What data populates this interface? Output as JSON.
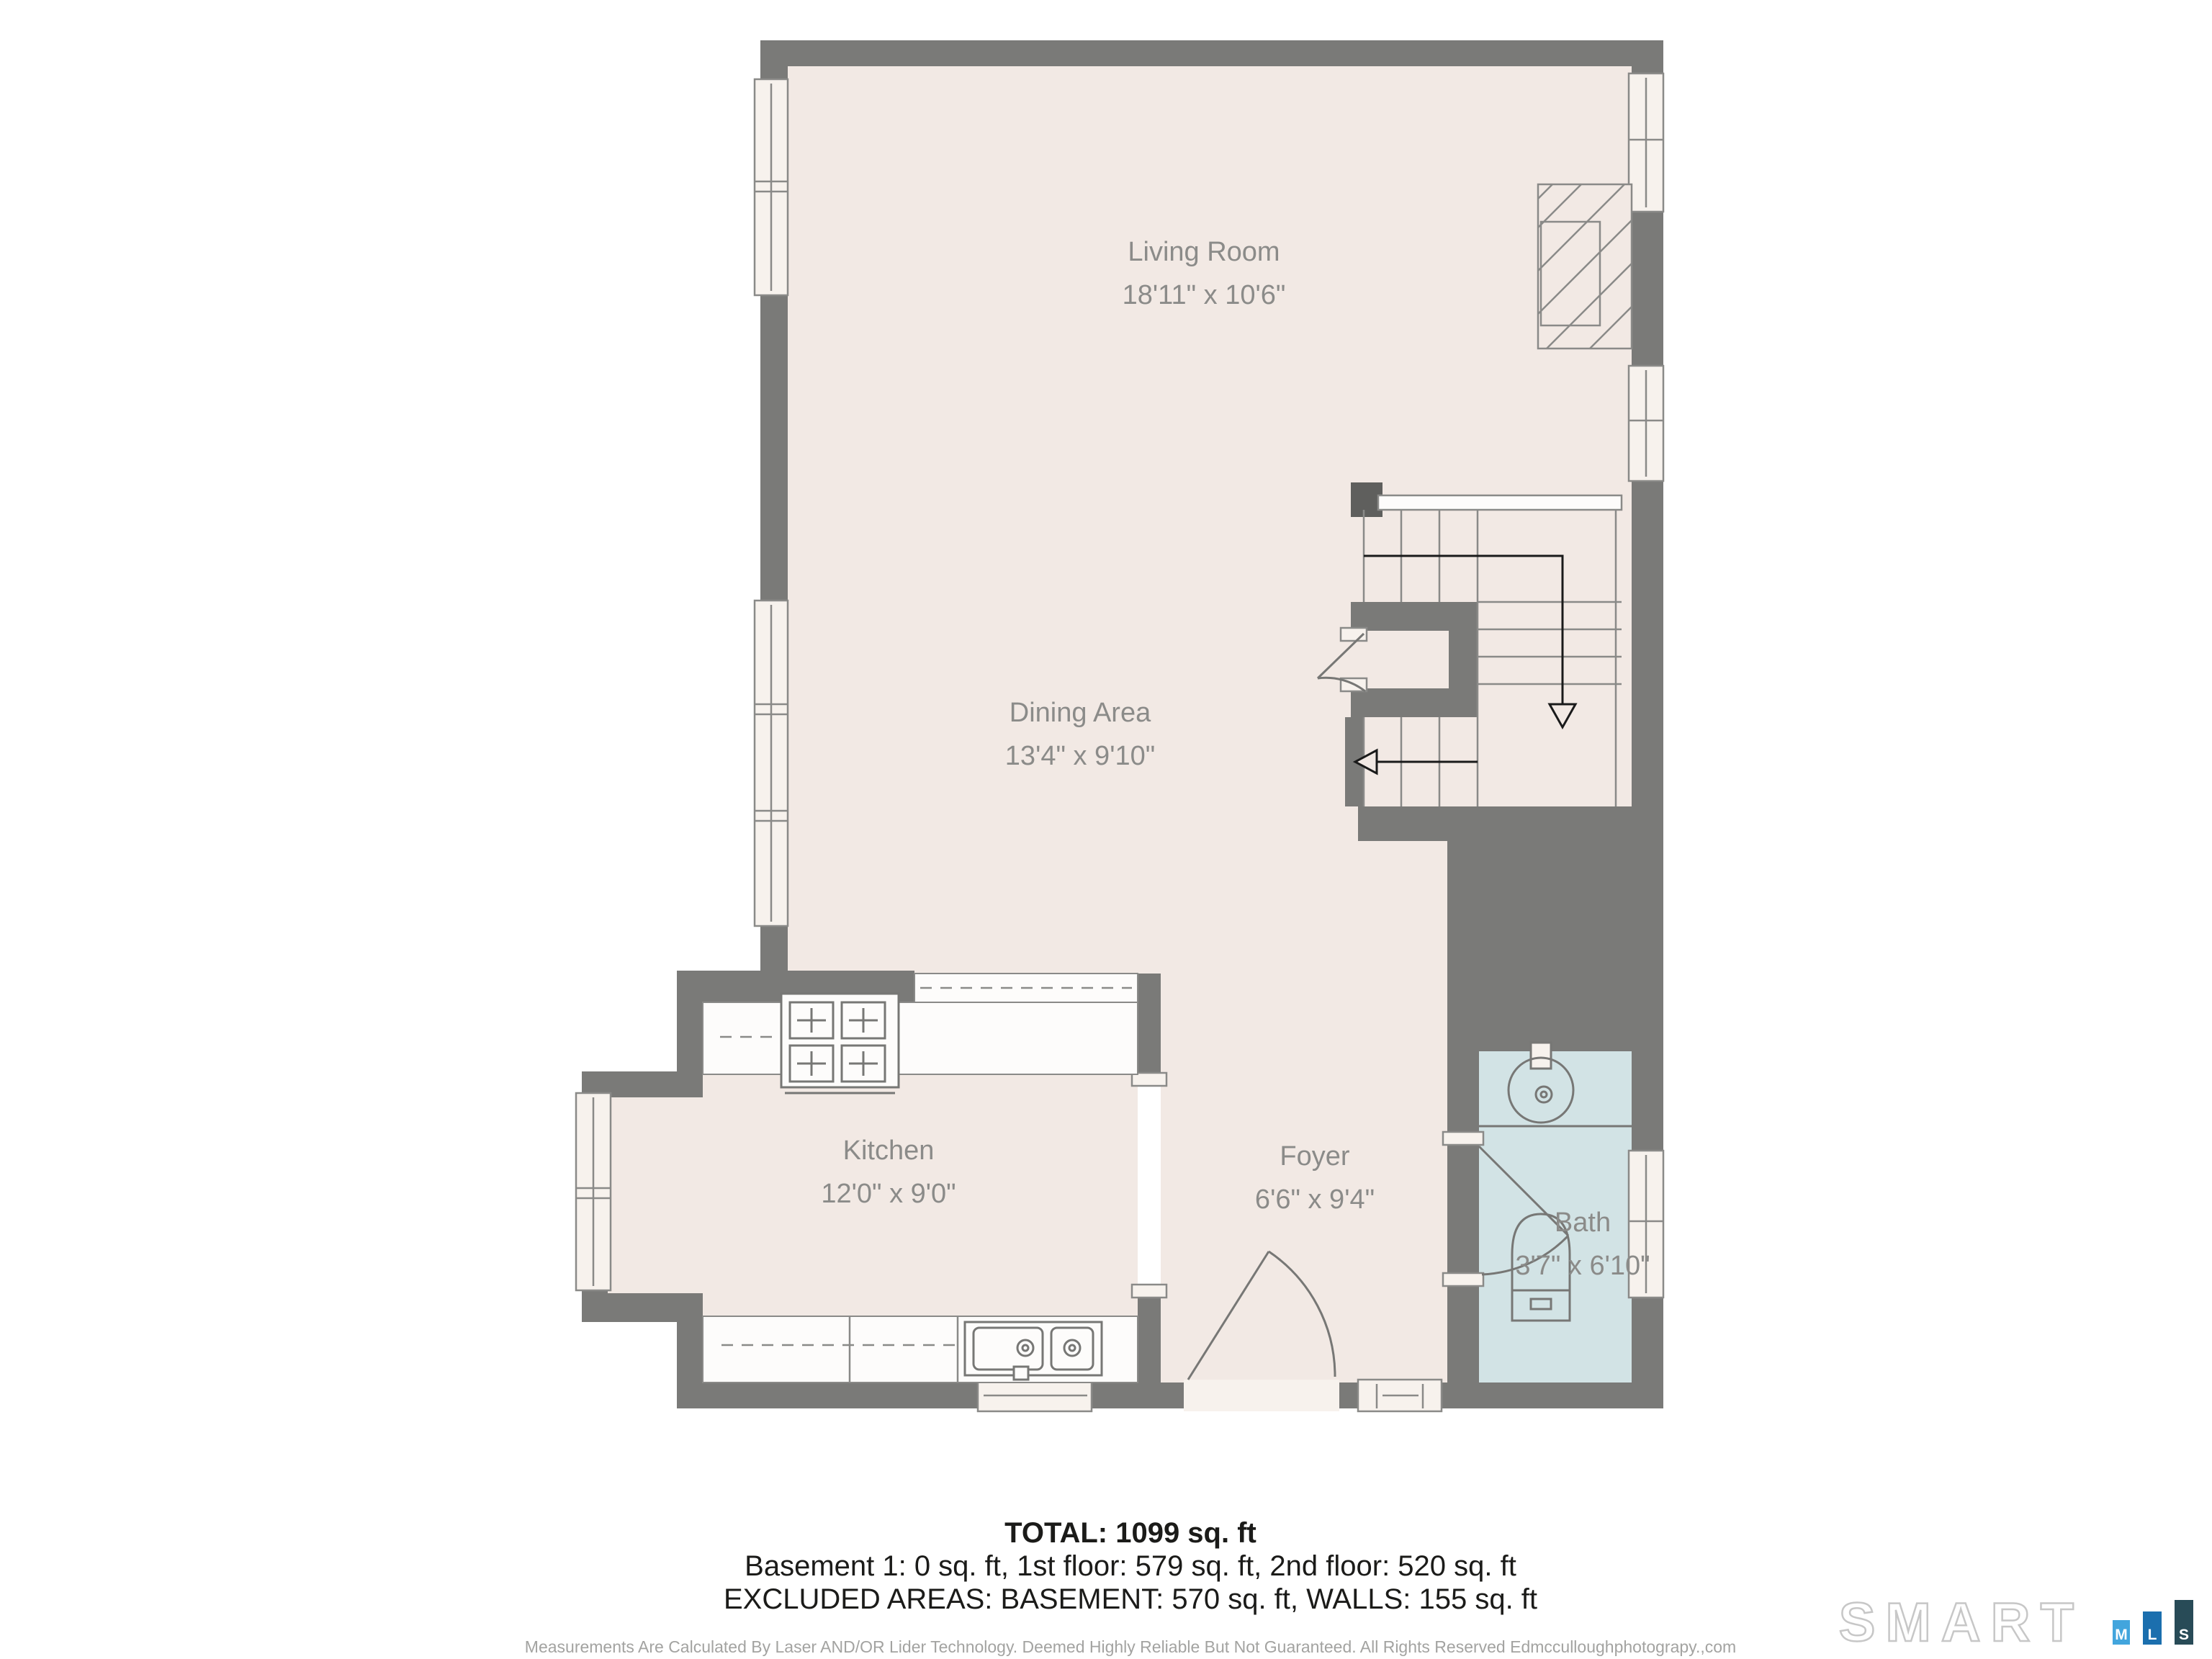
{
  "rooms": {
    "living": {
      "name": "Living Room",
      "dims": "18'11\" x 10'6\""
    },
    "dining": {
      "name": "Dining Area",
      "dims": "13'4\" x 9'10\""
    },
    "kitchen": {
      "name": "Kitchen",
      "dims": "12'0\" x 9'0\""
    },
    "foyer": {
      "name": "Foyer",
      "dims": "6'6\" x 9'4\""
    },
    "bath": {
      "name": "Bath",
      "dims": "3'7\" x 6'10\""
    }
  },
  "summary": {
    "total": "TOTAL: 1099 sq. ft",
    "floors": "Basement 1: 0 sq. ft, 1st floor: 579 sq. ft, 2nd floor: 520 sq. ft",
    "excluded": "EXCLUDED AREAS: BASEMENT: 570 sq. ft, WALLS: 155 sq. ft"
  },
  "disclaimer": "Measurements Are Calculated By Laser AND/OR Lider Technology. Deemed Highly Reliable But Not Guaranteed. All Rights Reserved Edmcculloughphotograpy.,com",
  "logo": {
    "brand": "SMART",
    "bars": [
      {
        "label": "M",
        "color": "#42a5dd"
      },
      {
        "label": "L",
        "color": "#1b6fae"
      },
      {
        "label": "S",
        "color": "#284b57"
      }
    ]
  },
  "colors": {
    "floor": "#f2e9e4",
    "wall": "#7a7a78",
    "bath_floor": "#d2e3e5",
    "counter": "#fdfcfb",
    "fixture_line": "#8a8a88",
    "label_text": "#8b8b89",
    "stair_arrow": "#111111"
  }
}
